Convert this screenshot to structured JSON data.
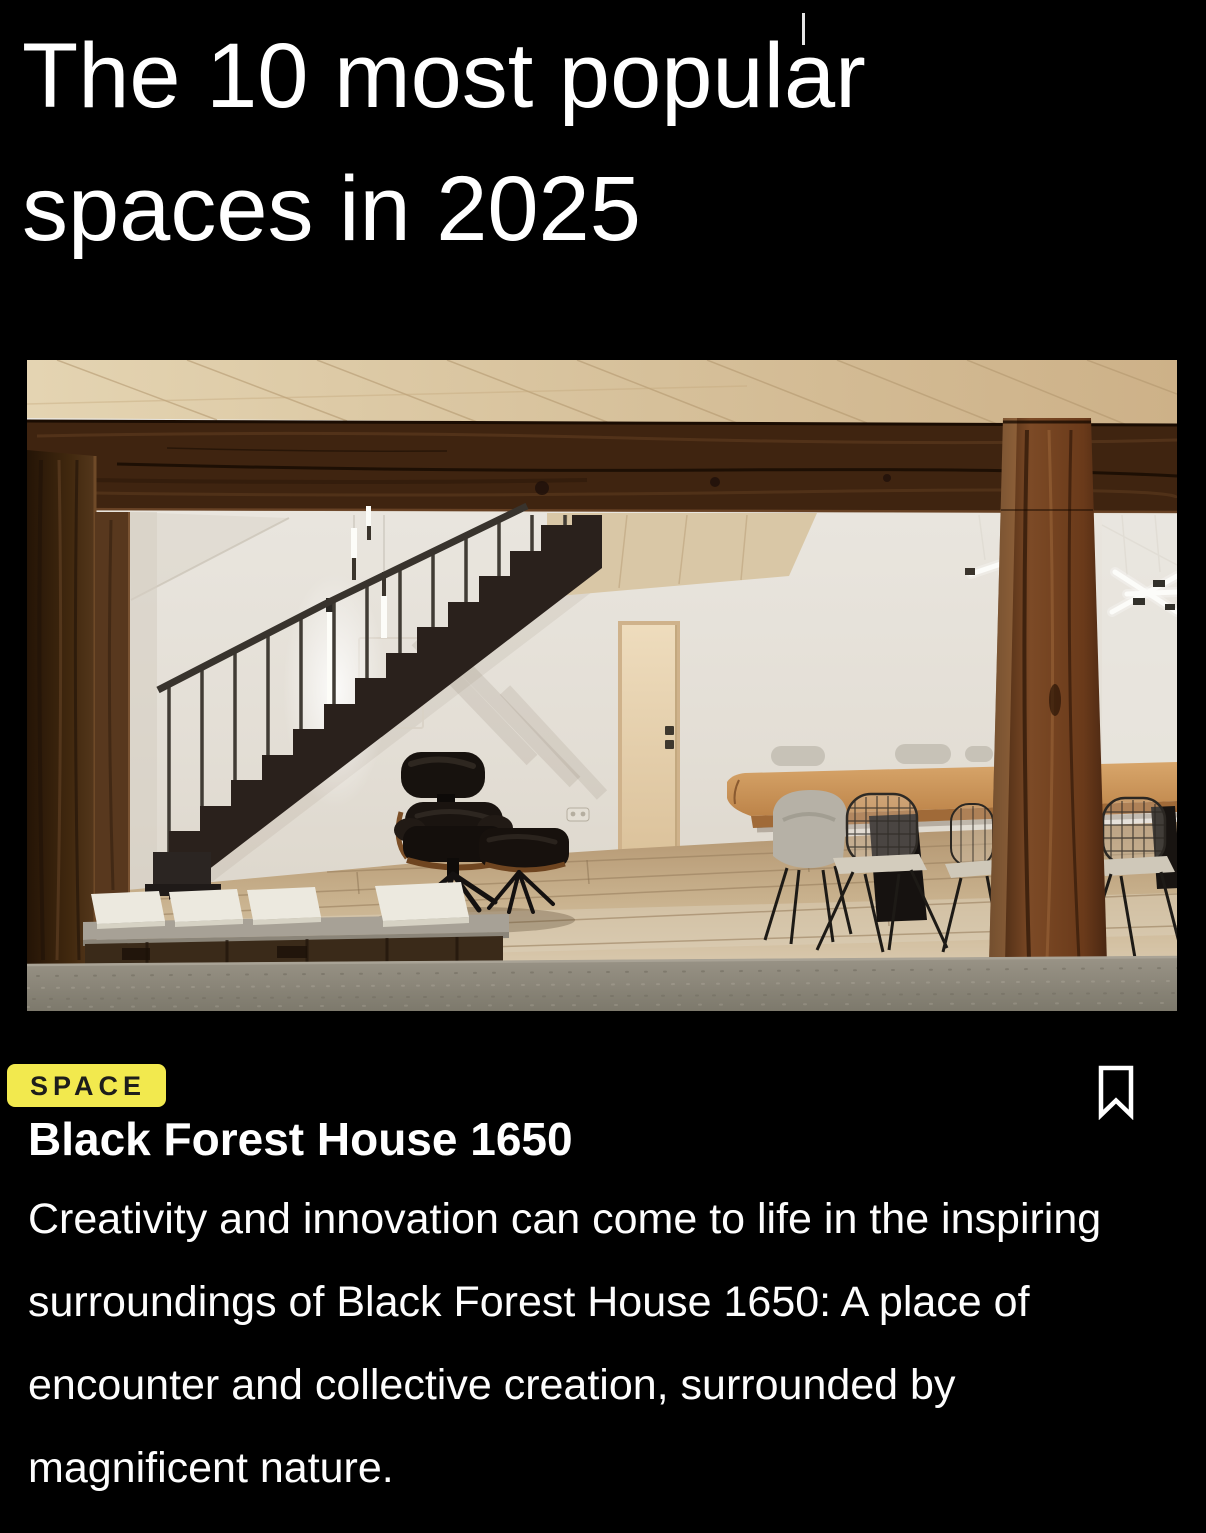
{
  "page": {
    "background": "#000000",
    "text_color": "#FFFFFF"
  },
  "header": {
    "title": "The 10 most popular spaces in 2025"
  },
  "card": {
    "category_badge": {
      "label": "SPACE",
      "background": "#F2E94E",
      "text_color": "#1D1D1B"
    },
    "bookmark": {
      "icon": "bookmark-outline",
      "aria_label": "Bookmark this article",
      "color": "#FFFFFF"
    },
    "headline": "Black Forest House 1650",
    "description": "Creativity and innovation can come to life in the inspiring surroundings of Black Forest House 1650: A place of encounter and collective creation, surrounded by magnificent nature.",
    "image_alt": "Converted farmhouse interior with rustic timber posts and beam, a black steel staircase, an Eames lounge chair with ottoman, a bench with white cushions and a long wooden dining table with wire chairs."
  }
}
